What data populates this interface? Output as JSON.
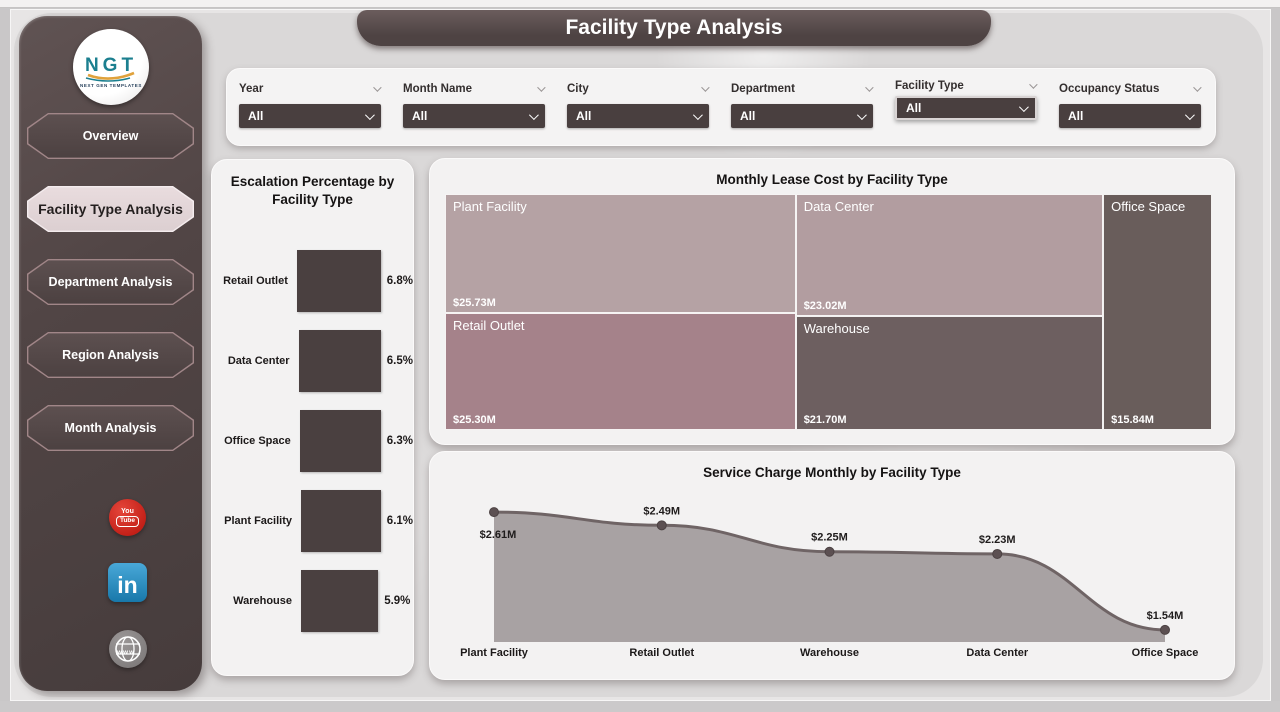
{
  "header": {
    "title": "Facility Type Analysis"
  },
  "sidebar": {
    "logo": {
      "text": "NGT",
      "subtext": "NEXT GEN TEMPLATES"
    },
    "items": [
      {
        "label": "Overview",
        "active": false
      },
      {
        "label": "Facility Type Analysis",
        "active": true
      },
      {
        "label": "Department Analysis",
        "active": false
      },
      {
        "label": "Region Analysis",
        "active": false
      },
      {
        "label": "Month Analysis",
        "active": false
      }
    ],
    "social_icons": [
      "youtube-icon",
      "linkedin-icon",
      "website-globe-icon"
    ]
  },
  "filters": [
    {
      "label": "Year",
      "value": "All",
      "highlighted": false
    },
    {
      "label": "Month Name",
      "value": "All",
      "highlighted": false
    },
    {
      "label": "City",
      "value": "All",
      "highlighted": false
    },
    {
      "label": "Department",
      "value": "All",
      "highlighted": false
    },
    {
      "label": "Facility Type",
      "value": "All",
      "highlighted": true
    },
    {
      "label": "Occupancy Status",
      "value": "All",
      "highlighted": false
    }
  ],
  "chart_data": [
    {
      "type": "bar",
      "orientation": "horizontal",
      "title": "Escalation Percentage by Facility Type",
      "categories": [
        "Retail Outlet",
        "Data Center",
        "Office Space",
        "Plant Facility",
        "Warehouse"
      ],
      "values": [
        6.8,
        6.5,
        6.3,
        6.1,
        5.9
      ],
      "value_labels": [
        "6.8%",
        "6.5%",
        "6.3%",
        "6.1%",
        "5.9%"
      ],
      "xlim": [
        0,
        6.8
      ],
      "bar_color": "#4a4040",
      "grid": false
    },
    {
      "type": "treemap",
      "title": "Monthly Lease Cost by Facility Type",
      "tiles": [
        {
          "name": "Plant Facility",
          "value": 25.73,
          "label": "$25.73M",
          "color": "#b5a2a4"
        },
        {
          "name": "Data Center",
          "value": 23.02,
          "label": "$23.02M",
          "color": "#b29da0"
        },
        {
          "name": "Office Space",
          "value": 15.84,
          "label": "$15.84M",
          "color": "#695d5b"
        },
        {
          "name": "Retail Outlet",
          "value": 25.3,
          "label": "$25.30M",
          "color": "#a5828a"
        },
        {
          "name": "Warehouse",
          "value": 21.7,
          "label": "$21.70M",
          "color": "#6d5f60"
        }
      ]
    },
    {
      "type": "area",
      "title": "Service Charge Monthly by Facility Type",
      "categories": [
        "Plant Facility",
        "Retail Outlet",
        "Warehouse",
        "Data Center",
        "Office Space"
      ],
      "values": [
        2.61,
        2.49,
        2.25,
        2.23,
        1.54
      ],
      "value_labels": [
        "$2.61M",
        "$2.49M",
        "$2.25M",
        "$2.23M",
        "$1.54M"
      ],
      "ylim": [
        1.43,
        2.72
      ],
      "line_color": "#6f6465",
      "fill_color": "#a8a2a3",
      "dot_color": "#5c5052",
      "grid": false,
      "legend": false
    }
  ]
}
